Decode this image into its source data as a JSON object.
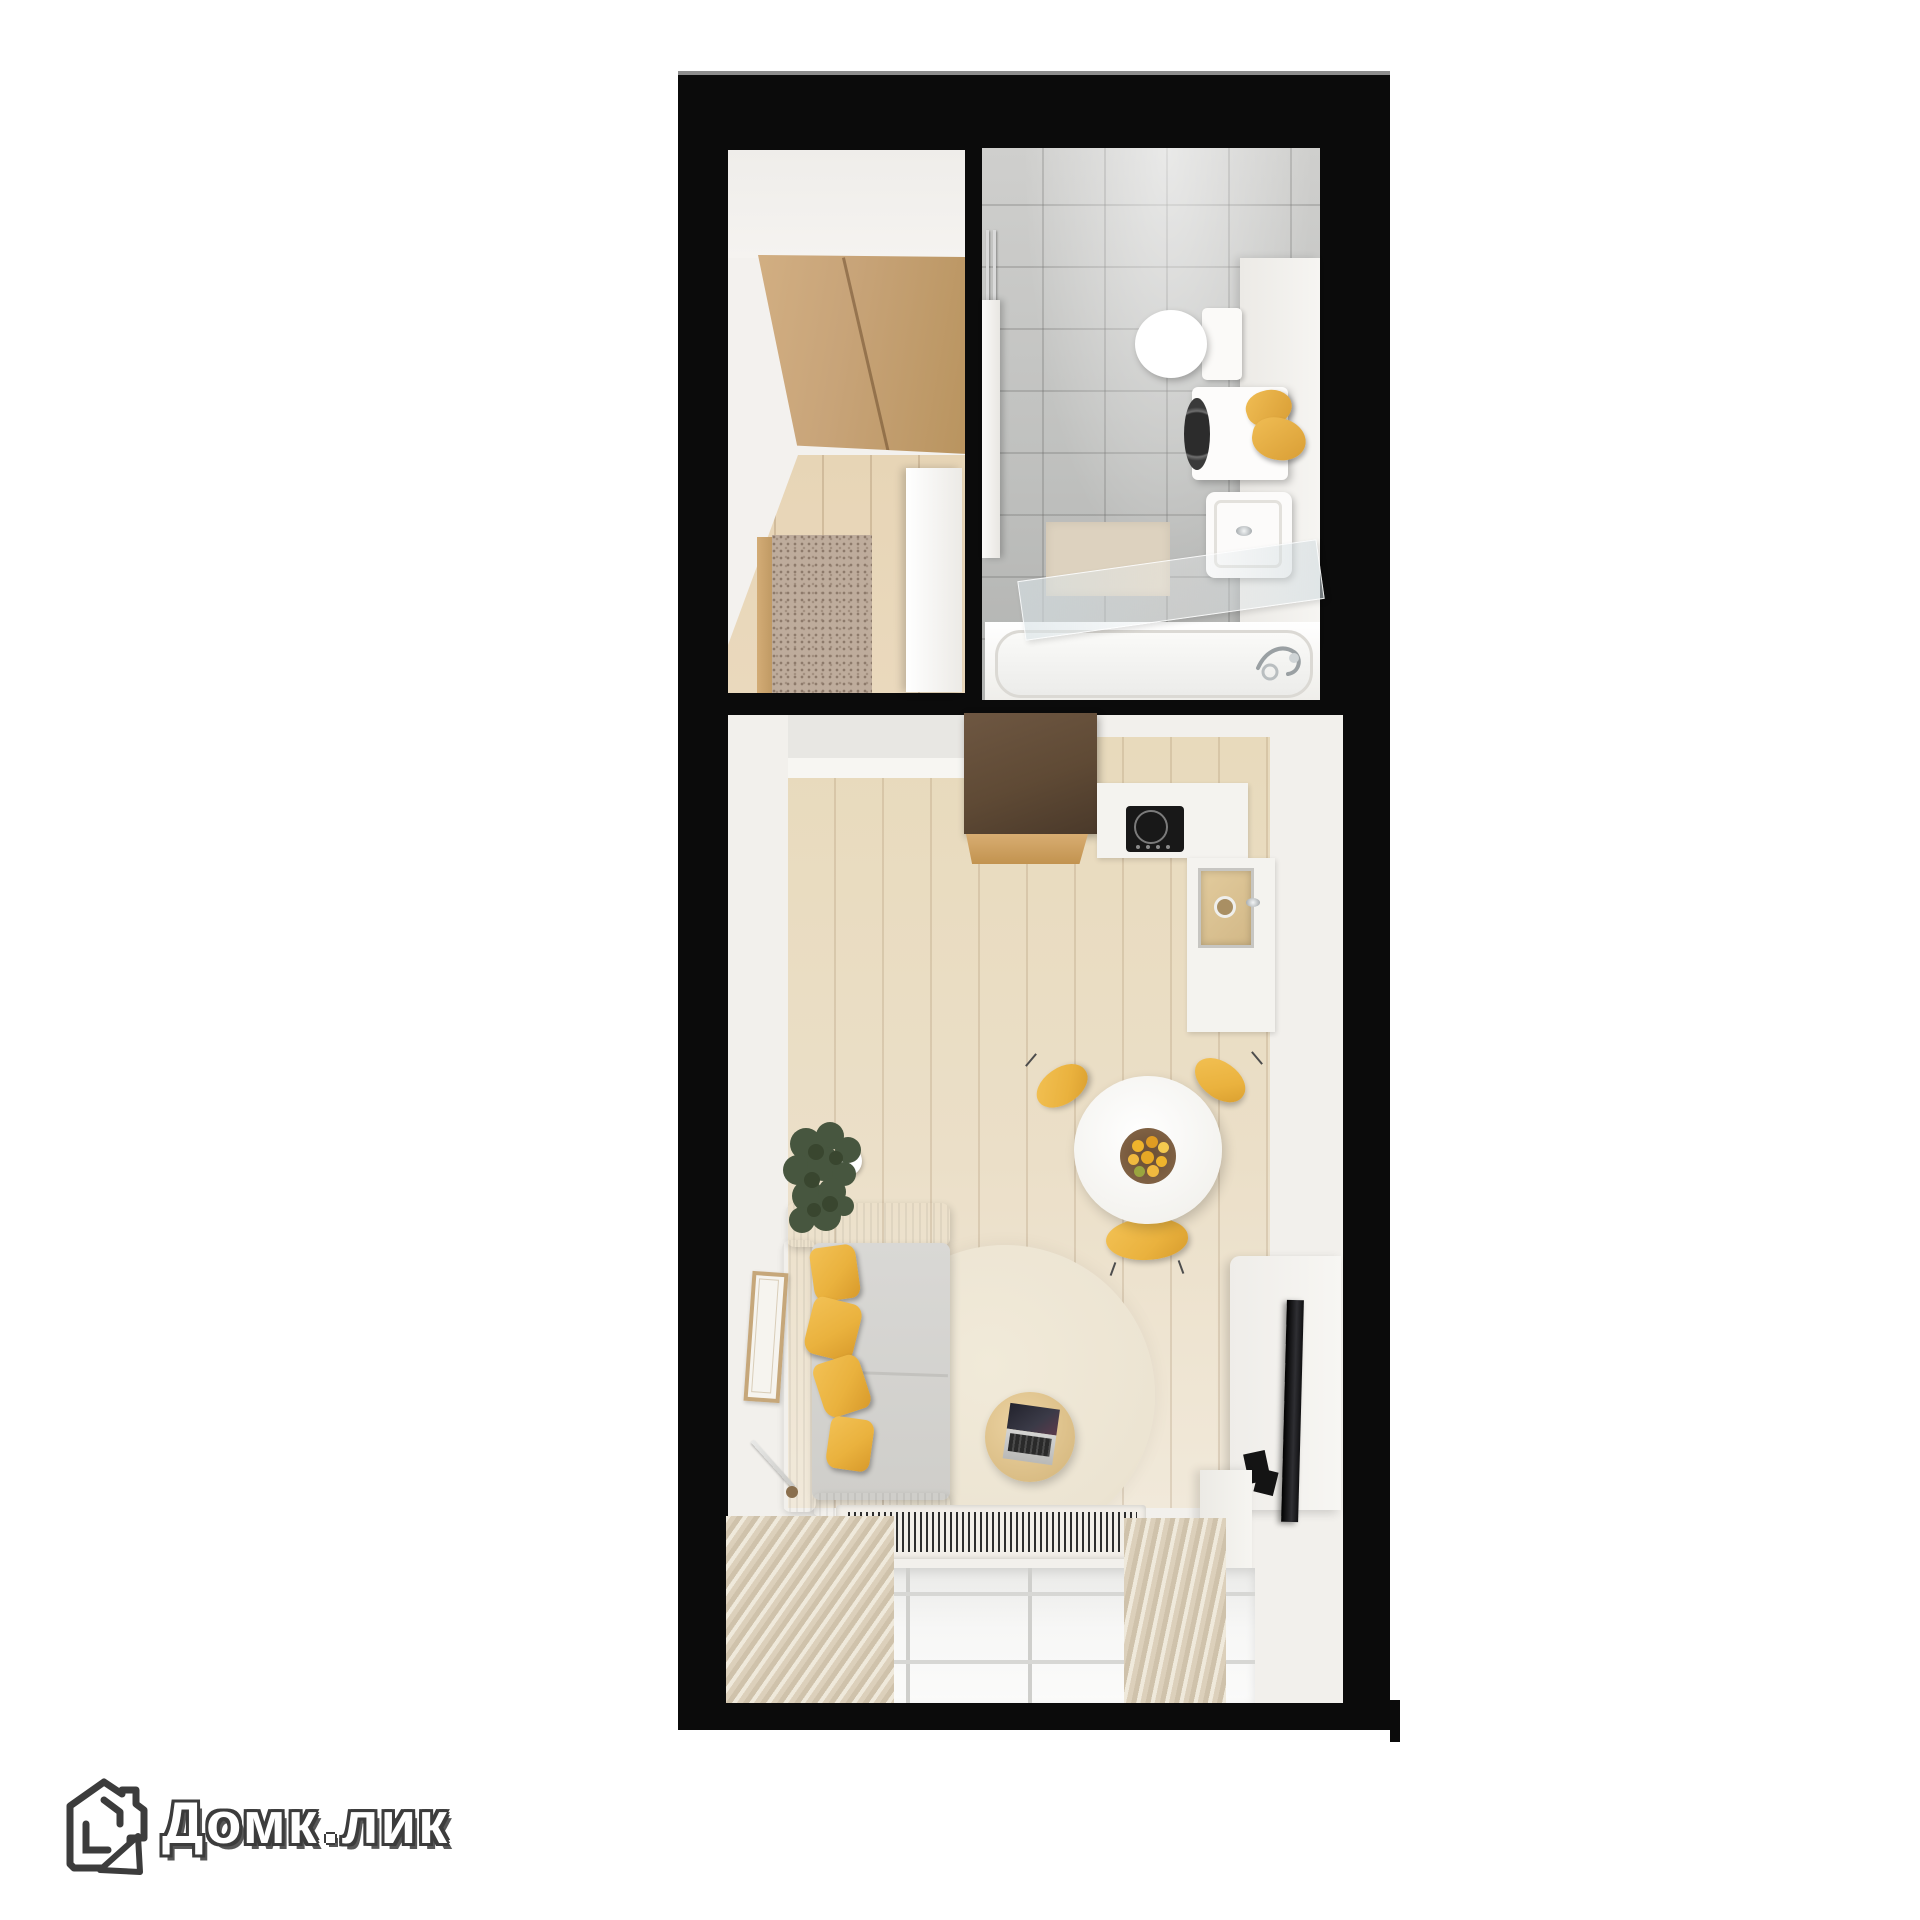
{
  "brand": {
    "name": "Домклик",
    "name_part1": "Домк",
    "name_part2": "лик",
    "logo_icon": "house-icon"
  },
  "colors": {
    "wall": "#0b0b0b",
    "background": "#ffffff",
    "hall_floor": "#ead9bd",
    "living_floor": "#ebdfc8",
    "wardrobe_wood": "#c8a479",
    "tile": "#c0c1bf",
    "accent_yellow": "#eab23e",
    "sofa_gray": "#d3d2cf",
    "cabinet_brown": "#5f4a35",
    "counter_white": "#f4f3ef",
    "rug": "#ece4d2",
    "hob_black": "#181818",
    "curtain": "#cfc2ab",
    "radiator_stripe": "#2e2e2e",
    "logo_outline": "#3c3c3c"
  },
  "plan": {
    "type": "apartment-floor-plan-3d-top-view",
    "rooms": [
      {
        "name": "hallway",
        "furniture": [
          "wardrobe",
          "doormat",
          "open-door"
        ]
      },
      {
        "name": "bathroom",
        "furniture": [
          "toilet",
          "washing-machine",
          "towels",
          "sink",
          "bathtub",
          "glass-screen",
          "bath-mat",
          "towel-rail",
          "open-door"
        ]
      },
      {
        "name": "living-kitchen",
        "furniture": [
          "tall-cabinet",
          "counter",
          "induction-hob",
          "kitchen-sink",
          "dining-table",
          "fruit-bowl",
          "chair",
          "chair",
          "chair",
          "round-rug",
          "coffee-table",
          "laptop",
          "sofa",
          "pillows",
          "plant",
          "picture-frame",
          "floor-lamp",
          "radiator",
          "curtains",
          "window",
          "tv-stand",
          "tv"
        ]
      }
    ]
  }
}
